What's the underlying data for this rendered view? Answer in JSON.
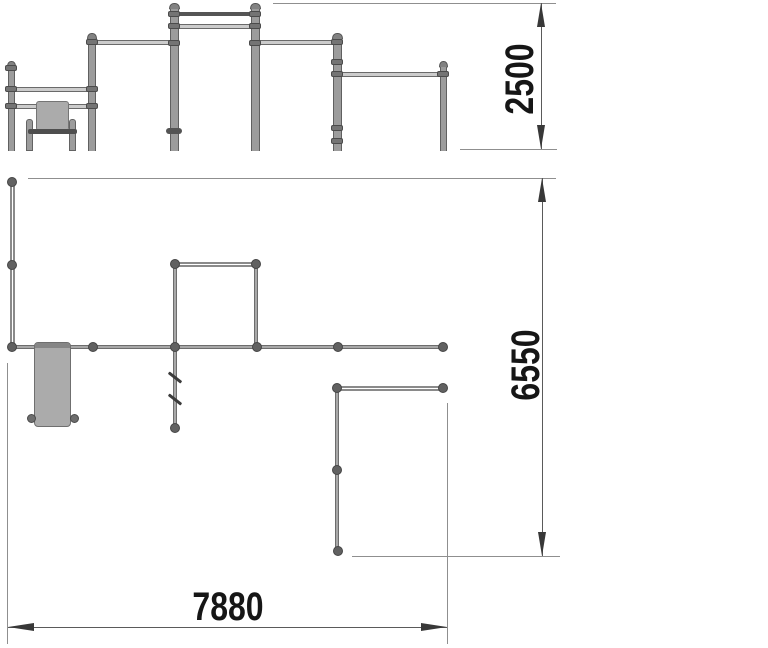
{
  "title": "street-workout-complex-technical-drawing",
  "colors": {
    "background": "#ffffff",
    "steel_gray": "#9c9c9c",
    "dark_fitting": "#555555",
    "dimension_text": "#161616",
    "dimension_line": "#5a5a5a",
    "extension_line": "#8f8f8f"
  },
  "dimensions": {
    "height": {
      "label": "2500"
    },
    "depth": {
      "label": "6550"
    },
    "width": {
      "label": "7880"
    }
  },
  "dim_geometry": {
    "height_2500": {
      "line": {
        "x": 541,
        "y1": 3,
        "y2": 149
      },
      "ext": [
        {
          "x1": 273,
          "y1": 3,
          "x2": 556,
          "y2": 3
        },
        {
          "x1": 460,
          "y1": 149,
          "x2": 557,
          "y2": 149
        }
      ]
    },
    "depth_6550": {
      "line": {
        "x": 542,
        "y1": 178,
        "y2": 556
      },
      "ext": [
        {
          "x1": 28,
          "y1": 178,
          "x2": 556,
          "y2": 178
        },
        {
          "x1": 352,
          "y1": 556,
          "x2": 560,
          "y2": 556
        }
      ]
    },
    "width_7880": {
      "line": {
        "y": 627,
        "x1": 8,
        "x2": 447
      },
      "ext": [
        {
          "x1": 7,
          "y1": 363,
          "x2": 7,
          "y2": 644
        },
        {
          "x1": 447,
          "y1": 403,
          "x2": 447,
          "y2": 644
        }
      ]
    }
  },
  "elevation": {
    "ground_y": 151,
    "posts": [
      {
        "x": 11,
        "top": 61,
        "w": 7
      },
      {
        "x": 92,
        "top": 33,
        "w": 8
      },
      {
        "x": 174,
        "top": 3,
        "w": 9
      },
      {
        "x": 255,
        "top": 3,
        "w": 9
      },
      {
        "x": 337,
        "top": 33,
        "w": 9
      },
      {
        "x": 443,
        "top": 61,
        "w": 7
      }
    ],
    "bars": [
      {
        "x1": 174,
        "x2": 255,
        "y": 14,
        "thick": true
      },
      {
        "x1": 174,
        "x2": 255,
        "y": 26
      },
      {
        "x1": 92,
        "x2": 174,
        "y": 42
      },
      {
        "x1": 255,
        "x2": 337,
        "y": 42
      },
      {
        "x1": 337,
        "x2": 443,
        "y": 74
      },
      {
        "x1": 11,
        "x2": 92,
        "y": 89
      },
      {
        "x1": 11,
        "x2": 92,
        "y": 106
      }
    ],
    "collars": [
      {
        "x": 11,
        "y": 68
      },
      {
        "x": 11,
        "y": 89
      },
      {
        "x": 11,
        "y": 106
      },
      {
        "x": 92,
        "y": 42
      },
      {
        "x": 92,
        "y": 89
      },
      {
        "x": 92,
        "y": 106
      },
      {
        "x": 174,
        "y": 14
      },
      {
        "x": 174,
        "y": 26
      },
      {
        "x": 174,
        "y": 43
      },
      {
        "x": 255,
        "y": 14
      },
      {
        "x": 255,
        "y": 26
      },
      {
        "x": 255,
        "y": 43
      },
      {
        "x": 337,
        "y": 42
      },
      {
        "x": 337,
        "y": 62
      },
      {
        "x": 337,
        "y": 74
      },
      {
        "x": 337,
        "y": 128
      },
      {
        "x": 337,
        "y": 141
      },
      {
        "x": 443,
        "y": 74
      }
    ],
    "peg": {
      "x": 174,
      "y": 131,
      "w": 16,
      "h": 6
    },
    "bench": {
      "backrest": {
        "x": 36,
        "y": 101,
        "w": 33,
        "h": 30
      },
      "seat": {
        "x": 28,
        "y": 129,
        "w": 49,
        "h": 5
      },
      "legs": [
        {
          "x": 26,
          "y": 119,
          "w": 7,
          "h": 32
        },
        {
          "x": 69,
          "y": 119,
          "w": 7,
          "h": 32
        }
      ]
    }
  },
  "plan": {
    "lines": [
      {
        "x1": 12,
        "y1": 182,
        "x2": 12,
        "y2": 347,
        "style": "double"
      },
      {
        "x1": 12,
        "y1": 347,
        "x2": 443,
        "y2": 347,
        "style": "solid"
      },
      {
        "x1": 175,
        "y1": 264,
        "x2": 256,
        "y2": 264,
        "style": "double"
      },
      {
        "x1": 175,
        "y1": 264,
        "x2": 175,
        "y2": 347,
        "style": "solid"
      },
      {
        "x1": 256,
        "y1": 264,
        "x2": 256,
        "y2": 347,
        "style": "solid"
      },
      {
        "x1": 175,
        "y1": 347,
        "x2": 175,
        "y2": 428,
        "style": "solid"
      },
      {
        "x1": 337,
        "y1": 388,
        "x2": 443,
        "y2": 388,
        "style": "double"
      },
      {
        "x1": 337,
        "y1": 388,
        "x2": 337,
        "y2": 551,
        "style": "solid"
      }
    ],
    "nodes": [
      {
        "x": 12,
        "y": 182
      },
      {
        "x": 12,
        "y": 265
      },
      {
        "x": 12,
        "y": 347
      },
      {
        "x": 93,
        "y": 347
      },
      {
        "x": 175,
        "y": 264
      },
      {
        "x": 256,
        "y": 264
      },
      {
        "x": 175,
        "y": 347
      },
      {
        "x": 257,
        "y": 347
      },
      {
        "x": 338,
        "y": 347
      },
      {
        "x": 443,
        "y": 347
      },
      {
        "x": 337,
        "y": 388
      },
      {
        "x": 443,
        "y": 388
      },
      {
        "x": 337,
        "y": 470
      },
      {
        "x": 338,
        "y": 551
      },
      {
        "x": 175,
        "y": 428
      }
    ],
    "rung_ticks": [
      {
        "x": 175,
        "y": 377
      },
      {
        "x": 175,
        "y": 399
      }
    ],
    "bench": {
      "rect": {
        "x": 34,
        "y": 342,
        "w": 37,
        "h": 85
      },
      "feet": [
        {
          "x": 31,
          "y": 418
        },
        {
          "x": 74,
          "y": 418
        }
      ]
    }
  }
}
